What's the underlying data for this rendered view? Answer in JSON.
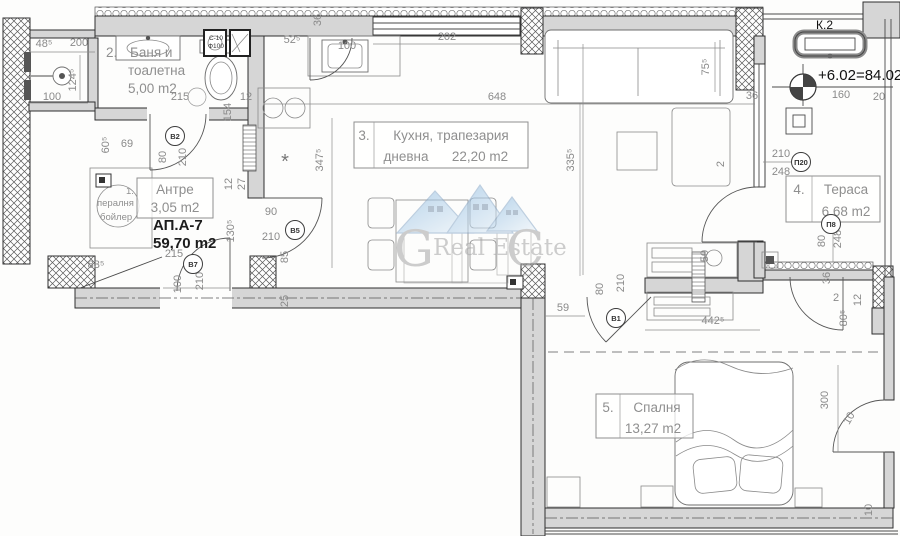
{
  "apartment": {
    "code": "АП.А-7",
    "area": "59,70 m2"
  },
  "rooms": {
    "laundry": {
      "number": "1.",
      "line1": "пералня",
      "line2": "бойлер"
    },
    "bathroom": {
      "number": "2.",
      "line1": "Баня и",
      "line2": "тоалетна",
      "area": "5,00 m2"
    },
    "kitchen": {
      "number": "3.",
      "line1": "Кухня, трапезария",
      "line2": "дневна",
      "area": "22,20 m2"
    },
    "terrace": {
      "number": "4.",
      "name": "Тераса",
      "area": "6,68 m2"
    },
    "bedroom": {
      "number": "5.",
      "name": "Спалня",
      "area": "13,27 m2"
    },
    "hall": {
      "name": "Антре",
      "area": "3,05 m2"
    }
  },
  "annotations": {
    "level_mark": "+6.02=84.02",
    "shaft": "К.2",
    "vent1": "С-10",
    "vent2": "Ф100",
    "ac_symbol": "*"
  },
  "watermark": {
    "left": "G",
    "center": "Real Estate",
    "right": "C"
  },
  "door_tags": [
    {
      "label": "В2",
      "x": 175,
      "y": 136
    },
    {
      "label": "В5",
      "x": 295,
      "y": 230
    },
    {
      "label": "В7",
      "x": 193,
      "y": 264
    },
    {
      "label": "В1",
      "x": 616,
      "y": 318
    },
    {
      "label": "П20",
      "x": 801,
      "y": 162
    },
    {
      "label": "П8",
      "x": 831,
      "y": 224
    }
  ],
  "dimensions": [
    {
      "t": "48⁵",
      "x": 44,
      "y": 47,
      "r": 0
    },
    {
      "t": "200",
      "x": 79,
      "y": 46,
      "r": 0
    },
    {
      "t": "124⁵",
      "x": 76,
      "y": 80,
      "r": -90
    },
    {
      "t": "100",
      "x": 52,
      "y": 100,
      "r": 0
    },
    {
      "t": "215",
      "x": 180,
      "y": 100,
      "r": 0
    },
    {
      "t": "154",
      "x": 231,
      "y": 112,
      "r": -90
    },
    {
      "t": "12",
      "x": 246,
      "y": 100,
      "r": 0
    },
    {
      "t": "52⁵",
      "x": 292,
      "y": 43,
      "r": 0
    },
    {
      "t": "36",
      "x": 321,
      "y": 20,
      "r": -90
    },
    {
      "t": "100",
      "x": 347,
      "y": 49,
      "r": 0
    },
    {
      "t": "202",
      "x": 447,
      "y": 40,
      "r": 0
    },
    {
      "t": "648",
      "x": 497,
      "y": 100,
      "r": 0
    },
    {
      "t": "75⁵",
      "x": 709,
      "y": 67,
      "r": -90
    },
    {
      "t": "36",
      "x": 752,
      "y": 99,
      "r": 0
    },
    {
      "t": "160",
      "x": 841,
      "y": 98,
      "r": 0
    },
    {
      "t": "20",
      "x": 879,
      "y": 100,
      "r": 0
    },
    {
      "t": "210",
      "x": 781,
      "y": 157,
      "r": 0
    },
    {
      "t": "248",
      "x": 781,
      "y": 175,
      "r": 0
    },
    {
      "t": "2",
      "x": 724,
      "y": 164,
      "r": -90
    },
    {
      "t": "335⁵",
      "x": 574,
      "y": 160,
      "r": -90
    },
    {
      "t": "347⁵",
      "x": 323,
      "y": 160,
      "r": -90
    },
    {
      "t": "60⁵",
      "x": 109,
      "y": 145,
      "r": -90
    },
    {
      "t": "69",
      "x": 127,
      "y": 147,
      "r": 0
    },
    {
      "t": "80",
      "x": 166,
      "y": 157,
      "r": -90
    },
    {
      "t": "210",
      "x": 186,
      "y": 157,
      "r": -90
    },
    {
      "t": "90",
      "x": 271,
      "y": 215,
      "r": 0
    },
    {
      "t": "210",
      "x": 271,
      "y": 240,
      "r": 0
    },
    {
      "t": "85",
      "x": 288,
      "y": 257,
      "r": -90
    },
    {
      "t": "12",
      "x": 232,
      "y": 184,
      "r": -90
    },
    {
      "t": "27",
      "x": 245,
      "y": 184,
      "r": -90
    },
    {
      "t": "130⁵",
      "x": 234,
      "y": 231,
      "r": -90
    },
    {
      "t": "215",
      "x": 174,
      "y": 257,
      "r": 0
    },
    {
      "t": "83⁵",
      "x": 96,
      "y": 268,
      "r": 0
    },
    {
      "t": "100",
      "x": 181,
      "y": 284,
      "r": -90
    },
    {
      "t": "210",
      "x": 203,
      "y": 281,
      "r": -90
    },
    {
      "t": "25",
      "x": 288,
      "y": 301,
      "r": -90
    },
    {
      "t": "59",
      "x": 563,
      "y": 311,
      "r": 0
    },
    {
      "t": "80",
      "x": 603,
      "y": 289,
      "r": -90
    },
    {
      "t": "210",
      "x": 624,
      "y": 283,
      "r": -90
    },
    {
      "t": "442⁵",
      "x": 713,
      "y": 324,
      "r": 0
    },
    {
      "t": "80",
      "x": 825,
      "y": 241,
      "r": -90
    },
    {
      "t": "248",
      "x": 841,
      "y": 239,
      "r": -90
    },
    {
      "t": "36",
      "x": 830,
      "y": 278,
      "r": -90
    },
    {
      "t": "2",
      "x": 836,
      "y": 301,
      "r": 0
    },
    {
      "t": "80⁵",
      "x": 847,
      "y": 318,
      "r": -90
    },
    {
      "t": "12",
      "x": 861,
      "y": 300,
      "r": -90
    },
    {
      "t": "50",
      "x": 708,
      "y": 256,
      "r": -90
    },
    {
      "t": "300",
      "x": 828,
      "y": 400,
      "r": -90
    },
    {
      "t": "10",
      "x": 852,
      "y": 420,
      "r": -60
    },
    {
      "t": "10",
      "x": 872,
      "y": 510,
      "r": -90
    }
  ]
}
